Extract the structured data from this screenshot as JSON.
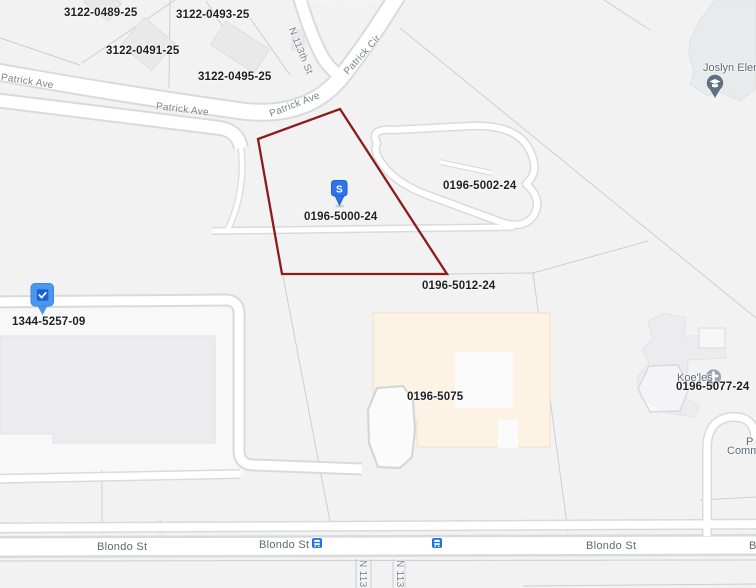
{
  "labels": {
    "parcels": [
      {
        "text": "3122-0489-25"
      },
      {
        "text": "3122-0493-25"
      },
      {
        "text": "3122-0491-25"
      },
      {
        "text": "3122-0495-25"
      },
      {
        "text": "3122-0497-25"
      },
      {
        "text": "0196-5002-24"
      },
      {
        "text": "0196-5000-24"
      },
      {
        "text": "0196-5012-24"
      },
      {
        "text": "1344-5257-09"
      },
      {
        "text": "0196-5075"
      },
      {
        "text": "0196-5077-24"
      }
    ],
    "streets": [
      {
        "text": "Patrick Ave"
      },
      {
        "text": "Patrick Ave"
      },
      {
        "text": "Patrick Ave"
      },
      {
        "text": "Patrick Cir"
      },
      {
        "text": "N 113th St"
      },
      {
        "text": "Blondo St"
      },
      {
        "text": "Blondo St"
      },
      {
        "text": "Blondo St"
      },
      {
        "text": "Blondo St"
      },
      {
        "text": "N 113th St"
      },
      {
        "text": "N 113th St"
      }
    ],
    "pois": {
      "school": "Joslyn Elemen",
      "church": "Koe'les",
      "right_line1": "P",
      "right_line2": "Commu"
    }
  },
  "markers": {
    "subject_letter": "S"
  },
  "icons": {
    "subject_marker": "s-pin",
    "selected_parcel_marker": "check-pin",
    "school_marker": "graduation-cap-pin",
    "church_marker": "cross-circle",
    "transit_stop": "bus-icon"
  },
  "colors": {
    "selected_outline": "#8e1b1b",
    "marker_blue": "#2e75ea",
    "pin_blue": "#4d96f0",
    "transit_blue": "#1a73e8",
    "school_pin": "#5e7082",
    "church_icon": "#99a3af",
    "building_cream": "#fdf3e4",
    "building_gray": "#ececee",
    "road_fill": "#ffffff",
    "background": "#f2f2f2"
  }
}
